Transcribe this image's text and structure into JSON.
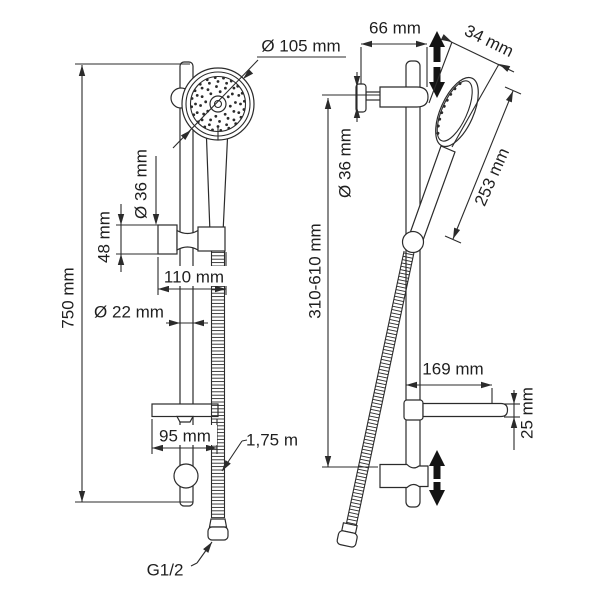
{
  "diagram": {
    "subject": "shower rail set dimension drawing",
    "colors": {
      "background": "#ffffff",
      "line": "#2b2b2b",
      "text": "#1f1f1f"
    },
    "front_view": {
      "dims": {
        "shower_head_diameter": "Ø 105 mm",
        "rail_length": "750 mm",
        "holder_diameter": "Ø 36 mm",
        "holder_height": "48 mm",
        "holder_reach": "110 mm",
        "rail_diameter": "Ø 22 mm",
        "soap_dish_width": "95 mm",
        "hose_length": "1,75 m",
        "hose_thread": "G1/2"
      }
    },
    "side_view": {
      "dims": {
        "wall_offset": "66 mm",
        "head_thickness": "34 mm",
        "bracket_diameter": "Ø 36 mm",
        "handshower_length": "253 mm",
        "height_adjust_range": "310-610 mm",
        "soap_dish_depth": "169 mm",
        "soap_dish_height": "25 mm"
      }
    }
  }
}
